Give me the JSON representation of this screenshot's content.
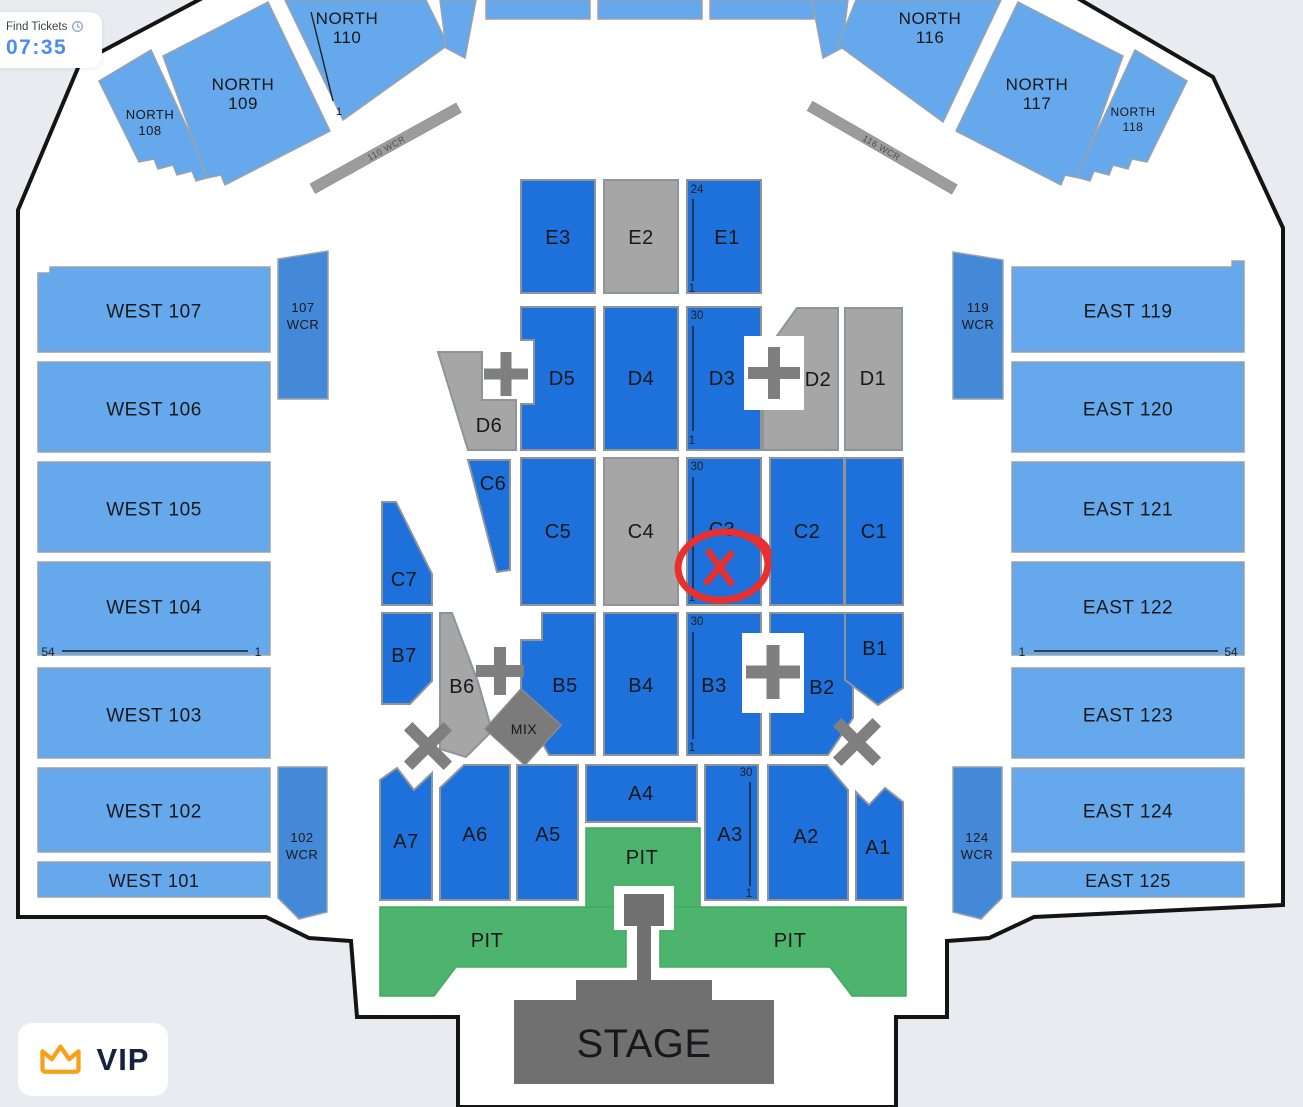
{
  "header": {
    "find_tickets": "Find Tickets",
    "timer": "07:35"
  },
  "vip": {
    "label": "VIP"
  },
  "north": {
    "n108": {
      "l1": "NORTH",
      "l2": "108"
    },
    "n109": {
      "l1": "NORTH",
      "l2": "109"
    },
    "n110": {
      "l1": "NORTH",
      "l2": "110"
    },
    "n116": {
      "l1": "NORTH",
      "l2": "116"
    },
    "n117": {
      "l1": "NORTH",
      "l2": "117"
    },
    "n118": {
      "l1": "NORTH",
      "l2": "118"
    }
  },
  "west": {
    "w107": "WEST 107",
    "w106": "WEST 106",
    "w105": "WEST 105",
    "w104": "WEST 104",
    "w103": "WEST 103",
    "w102": "WEST 102",
    "w101": "WEST 101",
    "wcr107": {
      "l1": "107",
      "l2": "WCR"
    },
    "wcr102": {
      "l1": "102",
      "l2": "WCR"
    }
  },
  "east": {
    "e119": "EAST 119",
    "e120": "EAST 120",
    "e121": "EAST 121",
    "e122": "EAST 122",
    "e123": "EAST 123",
    "e124": "EAST 124",
    "e125": "EAST 125",
    "wcr119": {
      "l1": "119",
      "l2": "WCR"
    },
    "wcr124": {
      "l1": "124",
      "l2": "WCR"
    }
  },
  "floor": {
    "e3": "E3",
    "e2": "E2",
    "e1": "E1",
    "d6": "D6",
    "d5": "D5",
    "d4": "D4",
    "d3": "D3",
    "d2": "D2",
    "d1": "D1",
    "c7": "C7",
    "c6": "C6",
    "c5": "C5",
    "c4": "C4",
    "c3": "C3",
    "c2": "C2",
    "c1": "C1",
    "b7": "B7",
    "b6": "B6",
    "b5": "B5",
    "b4": "B4",
    "b3": "B3",
    "b2": "B2",
    "b1": "B1",
    "a7": "A7",
    "a6": "A6",
    "a5": "A5",
    "a4": "A4",
    "a3": "A3",
    "a2": "A2",
    "a1": "A1",
    "mix": "MIX",
    "stage": "STAGE"
  },
  "pit": {
    "left": "PIT",
    "right": "PIT",
    "center": "PIT"
  },
  "markers": {
    "e1_top": "24",
    "e1_bottom": "1",
    "d3_top": "30",
    "d3_bottom": "1",
    "c3_top": "30",
    "c3_bottom": "1",
    "b3_top": "30",
    "b3_bottom": "1",
    "a3_top": "30",
    "a3_bottom": "1",
    "n110_first_row": "1",
    "w104_seat_left": "54",
    "w104_seat_right": "1",
    "e122_seat_left": "1",
    "e122_seat_right": "54",
    "wcr_bar_110": "110 WCR",
    "wcr_bar_116": "116 WCR"
  },
  "annotation": {
    "shape": "hand-drawn-circle-x",
    "target_section": "C3",
    "color": "#e8312e"
  },
  "colors": {
    "background": "#e9ebf0",
    "venue_fill": "#ffffff",
    "venue_outline": "#141414",
    "tier_blue": "#65a8eb",
    "wcr_blue": "#4489d8",
    "floor_blue": "#1e70db",
    "unavailable_gray": "#a6a6a6",
    "dark_gray": "#7b7b7b",
    "pit_green": "#4cb46d",
    "stage_gray": "#707070",
    "annotation_red": "#e8312e",
    "timer_blue": "#4c8bf5",
    "crown_orange": "#f7a11a",
    "vip_navy": "#16233e"
  }
}
